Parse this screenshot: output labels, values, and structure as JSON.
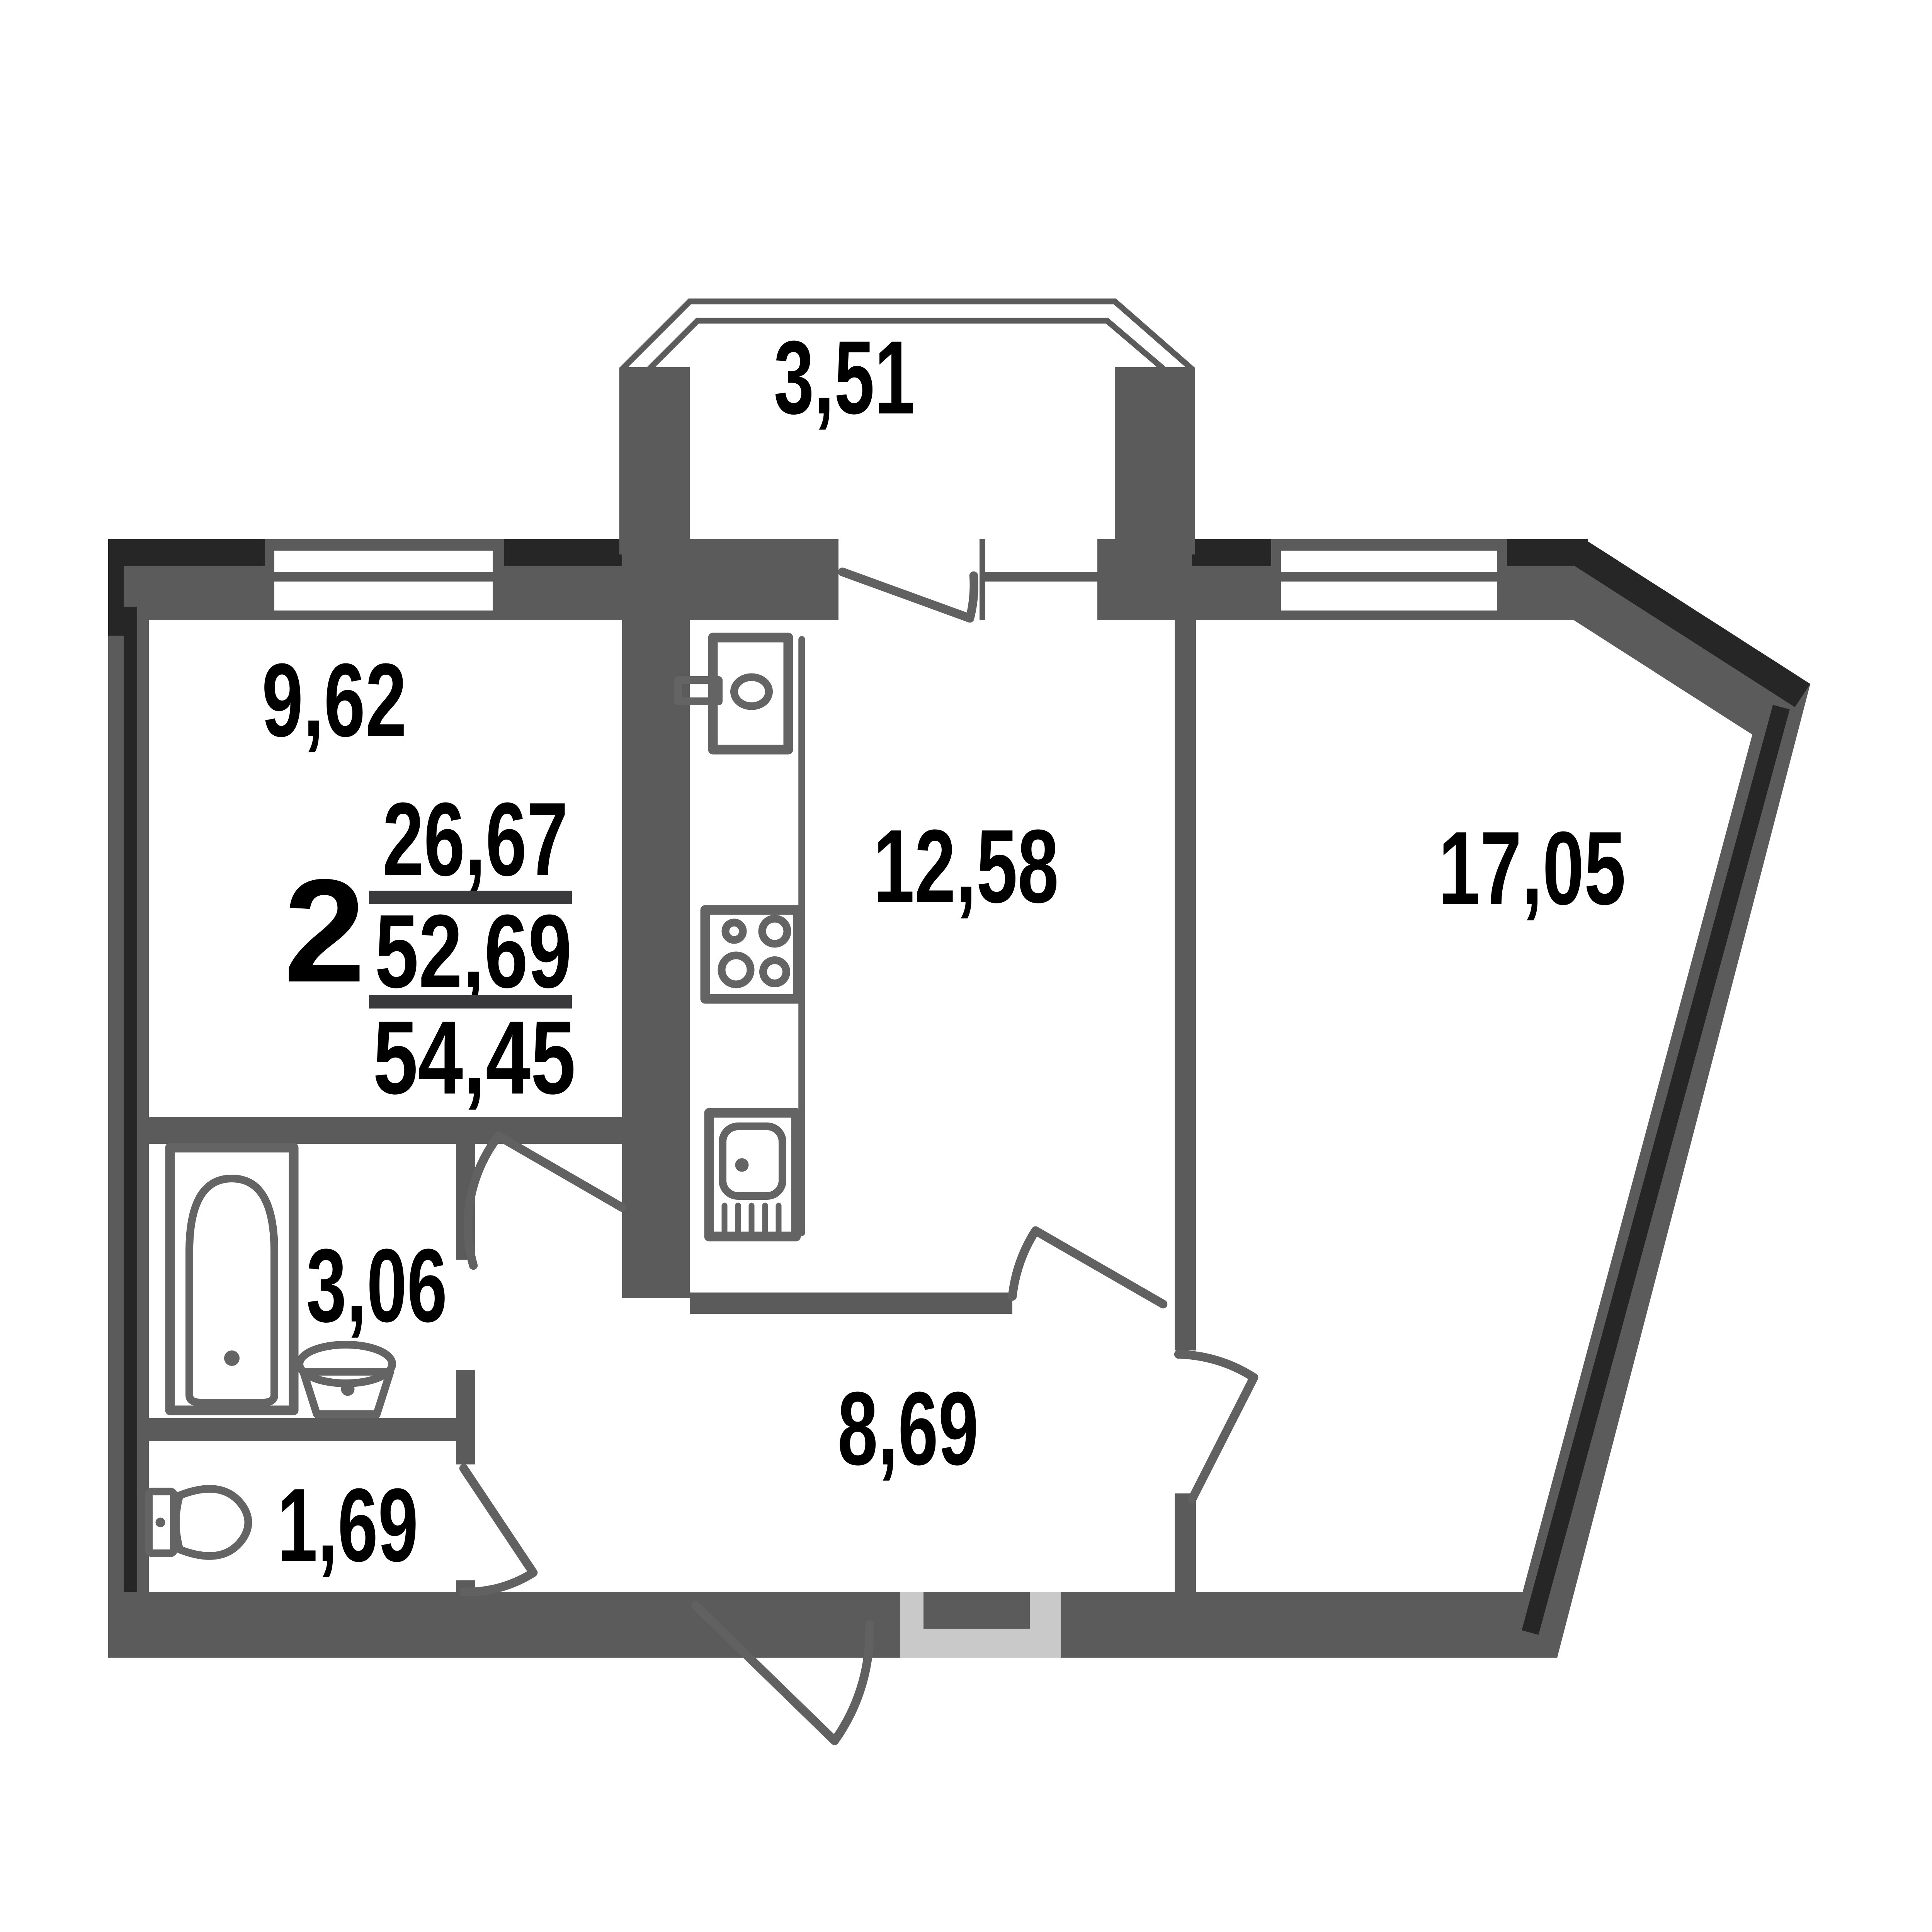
{
  "plan": {
    "summary": {
      "rooms_count": "2",
      "living_area": "26,67",
      "apartment_area": "52,69",
      "total_area": "54,45"
    },
    "areas": {
      "balcony": "3,51",
      "room": "9,62",
      "kitchen": "12,58",
      "living_room": "17,05",
      "bathroom": "3,06",
      "wc": "1,69",
      "hallway": "8,69"
    },
    "colors": {
      "wall": "#5b5b5b",
      "wall_outline_dark": "#262626",
      "fixtures": "#646464",
      "entrance_niche": "#c9c9c9",
      "labels": "#000000",
      "background": "#ffffff"
    }
  }
}
